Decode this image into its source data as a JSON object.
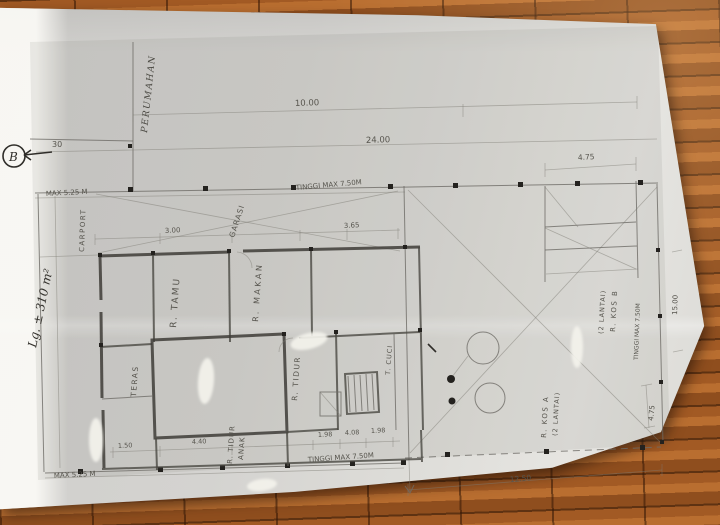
{
  "handwriting": {
    "section_marker": "B",
    "land_area": "Lg. ± 310 m²",
    "street": "PERUMAHAN",
    "small_dim": "30"
  },
  "dims": {
    "top_small": "10.00",
    "overall": "24.00",
    "top_right": "4.75",
    "right_height": "15.00",
    "right_lower": "4.75",
    "bottom_right": "12.50",
    "garage_a": "3.00",
    "garage_b": "3.65",
    "teras": "1.50",
    "bed": "4.40",
    "b1": "1.98",
    "b2": "4.08",
    "b3": "1.98"
  },
  "limits": {
    "front_left": "MAX 5.25 M",
    "front": "TINGGI MAX 7.50M",
    "rear": "TINGGI MAX 7.50M",
    "rear_left": "MAX 5.25 M",
    "right_side": "TINGGI MAX 7.50M"
  },
  "rooms": {
    "carport": "CARPORT",
    "garage": "GARASI",
    "living": "R. TAMU",
    "dining": "R. MAKAN",
    "bed": "R. TIDUR",
    "bed_kids_1": "R. TIDUR",
    "bed_kids_2": "ANAK",
    "terrace": "TERAS",
    "laundry": "T. CUCI",
    "kos_b_name": "R. KOS B",
    "kos_b_floors": "(2 LANTAI)",
    "kos_a_name": "R. KOS A",
    "kos_a_floors": "(2 LANTAI)"
  }
}
